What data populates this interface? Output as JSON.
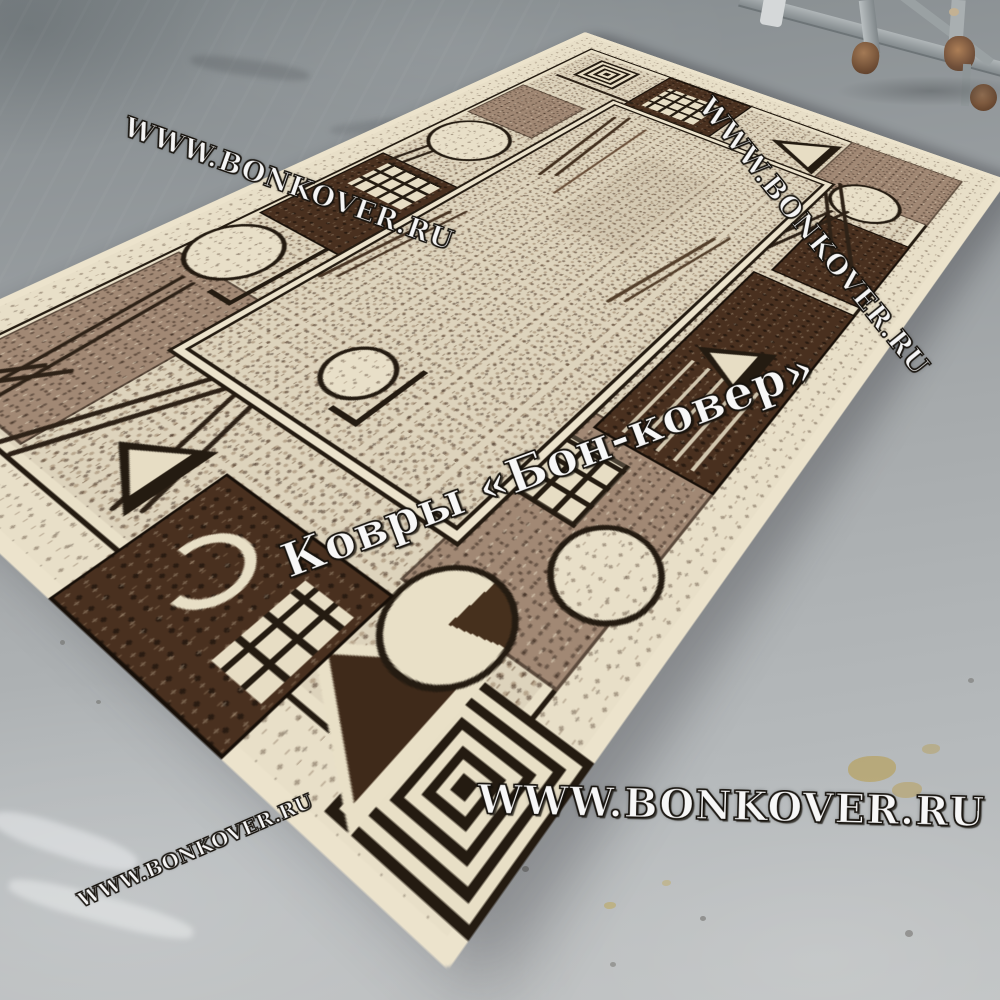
{
  "scene": {
    "type": "product-photo",
    "subject": "Beige rug with brown geometric border pattern on gray painted concrete floor",
    "watermarks": {
      "top_left": "WWW.BONKOVER.RU",
      "top_right": "WWW.BONKOVER.RU",
      "center": "Ковры «Бон-ковер»",
      "bottom_center": "WWW.BONKOVER.RU",
      "bottom_left": "WWW.BONKOVER.RU"
    },
    "palette": {
      "floor_gray": "#a7acae",
      "rug_cream": "#ddd3bc",
      "rug_tan": "#a18874",
      "rug_dark_brown": "#49301f",
      "rug_outline_black": "#241b11",
      "rug_binding": "#ece3cc",
      "caster_rust": "#7a5138",
      "stain_ochre": "#b89a45"
    }
  }
}
